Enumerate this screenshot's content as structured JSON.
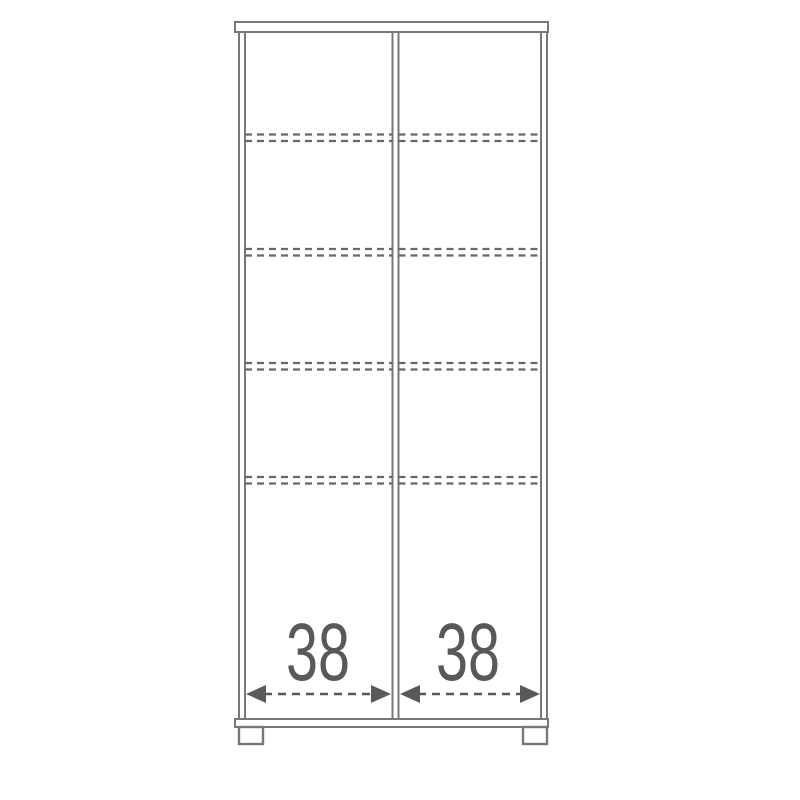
{
  "diagram": {
    "type": "furniture-dimension-drawing",
    "description": "two-door cabinet front elevation with shelf positions and width dimensions",
    "canvas": {
      "width": 800,
      "height": 800,
      "background": "#ffffff"
    },
    "style": {
      "frame_color": "#787878",
      "frame_width": 2,
      "panel_fill": "#ffffff",
      "shelf_dash_color": "#686868",
      "shelf_dash_width": 2.2,
      "shelf_dash_pattern": "7 5",
      "dim_color": "#58595b",
      "dim_dash_pattern": "8 6",
      "dim_line_width": 2.6,
      "label_font_size": 82,
      "label_text_length": 64
    },
    "cabinet": {
      "top_panel": {
        "x": 235,
        "y": 22,
        "width": 313,
        "height": 10
      },
      "bottom_panel": {
        "x": 235,
        "y": 719,
        "width": 313,
        "height": 8
      },
      "body_top_y": 32,
      "body_bottom_y": 719,
      "wall_xs": [
        239,
        245,
        392.5,
        398.5,
        541,
        547
      ],
      "feet": [
        {
          "x": 239,
          "y": 727,
          "width": 24,
          "height": 17
        },
        {
          "x": 523,
          "y": 727,
          "width": 24,
          "height": 17
        }
      ]
    },
    "shelves": {
      "compartments": [
        [
          245,
          392.5
        ],
        [
          398.5,
          541
        ]
      ],
      "y_pairs": [
        [
          134.5,
          141
        ],
        [
          249,
          255.5
        ],
        [
          363,
          369.5
        ],
        [
          477,
          483.5
        ]
      ]
    },
    "dimensions": [
      {
        "label": "38",
        "y": 694,
        "x1": 246,
        "x2": 391,
        "label_x": 318,
        "label_y": 680,
        "head_length": 20,
        "head_half_height": 9
      },
      {
        "label": "38",
        "y": 694,
        "x1": 400,
        "x2": 540,
        "label_x": 468,
        "label_y": 680,
        "head_length": 20,
        "head_half_height": 9
      }
    ]
  }
}
